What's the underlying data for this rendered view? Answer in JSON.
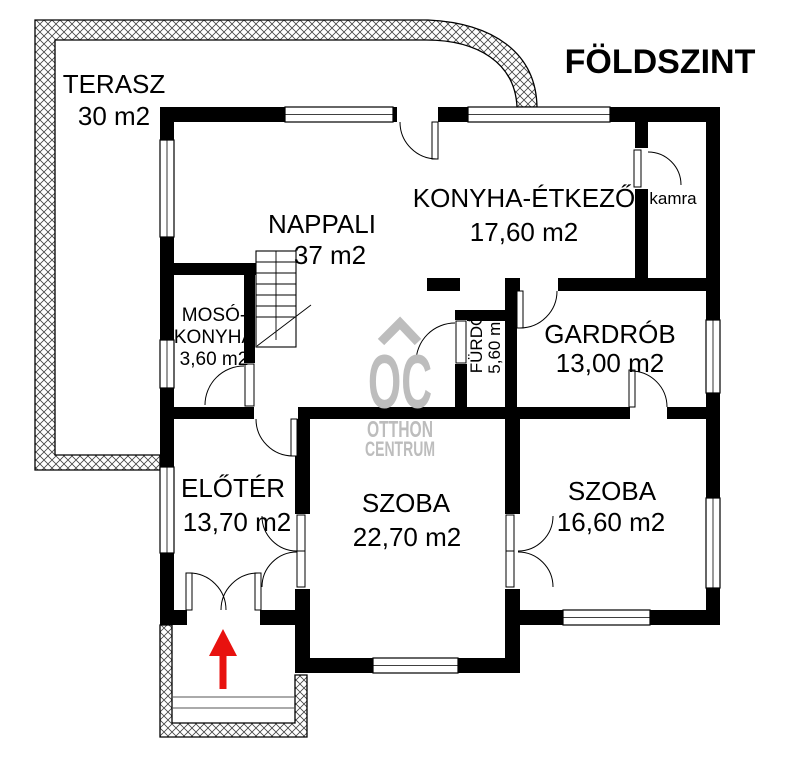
{
  "title": "FÖLDSZINT",
  "rooms": {
    "terasz": {
      "name": "TERASZ",
      "area": "30 m2"
    },
    "nappali": {
      "name": "NAPPALI",
      "area": "37 m2"
    },
    "konyha": {
      "name": "KONYHA-ÉTKEZŐ",
      "area": "17,60 m2"
    },
    "kamra": {
      "name": "kamra"
    },
    "moso": {
      "name_line1": "MOSÓ-",
      "name_line2": "KONYHA",
      "area": "3,60 m2"
    },
    "furdo": {
      "name": "FÜRDŐ",
      "area": "5,60 m2"
    },
    "gardrob": {
      "name": "GARDRÓB",
      "area": "13,00 m2"
    },
    "eloter": {
      "name": "ELŐTÉR",
      "area": "13,70 m2"
    },
    "szoba_nagy": {
      "name": "SZOBA",
      "area": "22,70 m2"
    },
    "szoba_kis": {
      "name": "SZOBA",
      "area": "16,60 m2"
    }
  },
  "watermark": {
    "logo": "OC",
    "line1": "OTTHON",
    "line2": "CENTRUM"
  },
  "colors": {
    "wall": "#000000",
    "background": "#ffffff",
    "watermark_gray": "#bdbdbd",
    "entry_arrow_red": "#e8120f"
  }
}
